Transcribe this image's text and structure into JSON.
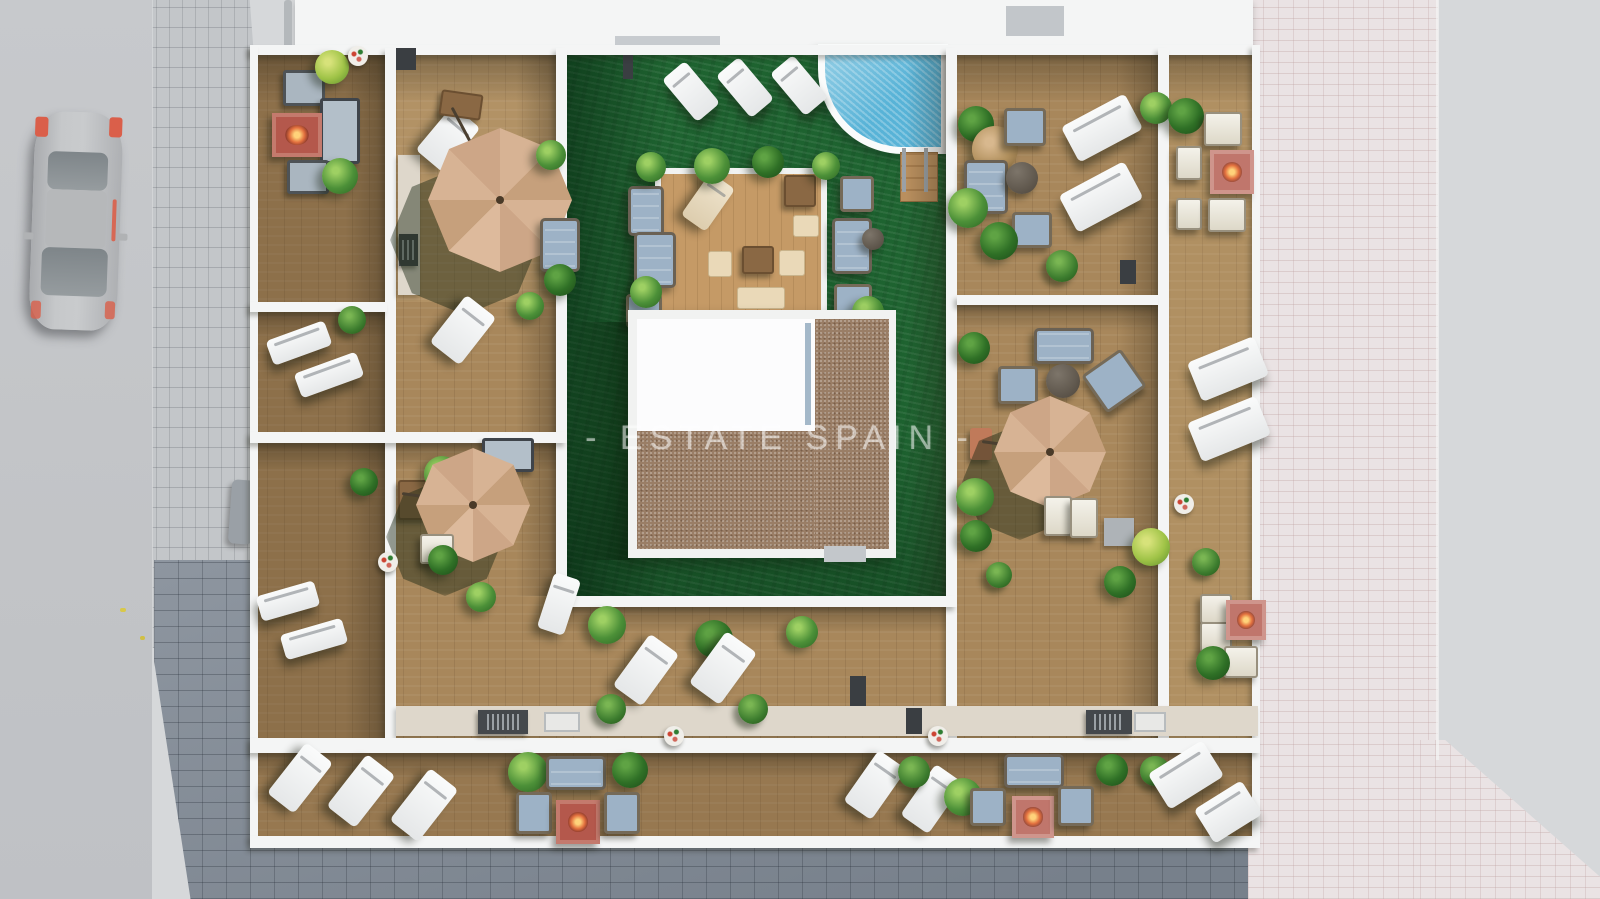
{
  "scene": {
    "type": "aerial-3d-architectural-render",
    "description": "Top-down 3D render of a residential rooftop terrace plan: communal courtyard with swimming pool, lawn and pergola lounge deck, surrounded by furnished private wooden terraces, a street with a parked car on the left and paved promenades around",
    "watermark": "- ESTATE SPAIN -"
  },
  "inventory": {
    "courtyard": [
      "swimming-pool",
      "artificial-lawn",
      "pergola-lounge-deck",
      "building-core-roof-white",
      "building-core-roof-gravel"
    ],
    "terraces": "wooden decks furnished with sun loungers, sofa sets, armchairs, fire-pit tables, parasols, barbecue counters and plants",
    "parasol_count": 3,
    "surroundings": [
      "asphalt-road",
      "parked-car",
      "light-stone-sidewalk",
      "dark-cobble-pavement",
      "pink-cobble-promenade",
      "white-neighbor-roof"
    ]
  },
  "colors": {
    "bg": "#d6d8da",
    "road": "#c7c9cc",
    "cobble_light": "#c3c6c9",
    "cobble_dark": "#8e96a0",
    "cobble_pink": "#eae3e4",
    "wall": "#f4f5f5",
    "wood": "#a8875b",
    "wood_light": "#c59a66",
    "lawn": "#1e6330",
    "pool": "#58b3d7",
    "gravel": "#9a7e66",
    "roof": "#fcfcfd",
    "umbrella": "#d7b394",
    "sofa": "#9db2c6",
    "fire_red": "#b4584c",
    "fire_pink": "#c0766c",
    "car": "#b9bbbd",
    "watermark": "#ffffff"
  }
}
